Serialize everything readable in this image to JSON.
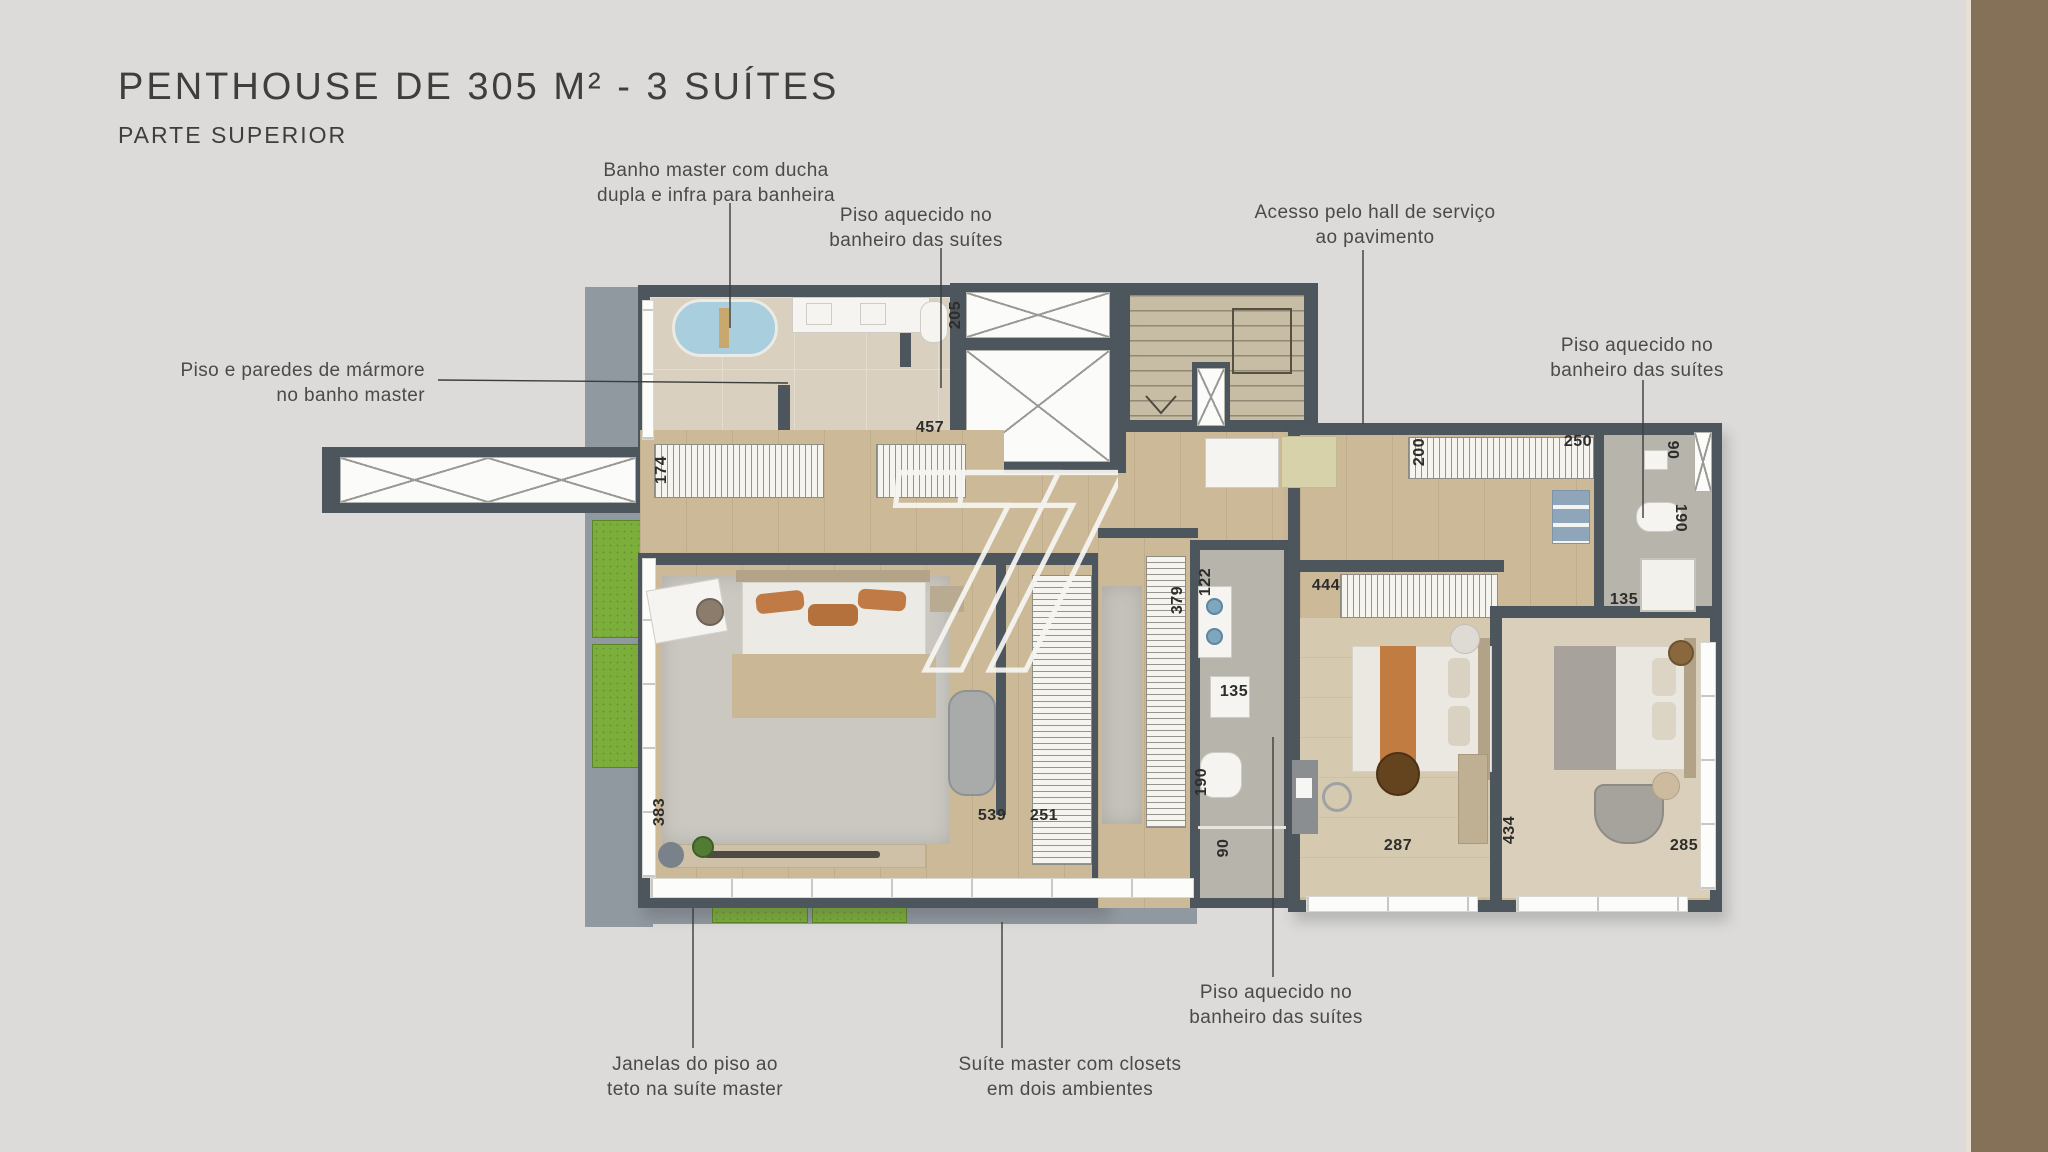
{
  "title": {
    "main": "PENTHOUSE DE 305 M² - 3 SUÍTES",
    "subtitle": "PARTE SUPERIOR"
  },
  "watermark_logo": "7",
  "annotations": [
    {
      "line1": "Banho master com ducha",
      "line2": "dupla e infra para banheira"
    },
    {
      "line1": "Piso aquecido no",
      "line2": "banheiro das suítes"
    },
    {
      "line1": "Acesso pelo hall de serviço",
      "line2": "ao pavimento"
    },
    {
      "line1": "Piso aquecido no",
      "line2": "banheiro das suítes"
    },
    {
      "line1": "Piso e paredes de mármore",
      "line2": "no banho master"
    },
    {
      "line1": "Janelas do piso ao",
      "line2": "teto na suíte master"
    },
    {
      "line1": "Suíte master com closets",
      "line2": "em dois ambientes"
    },
    {
      "line1": "Piso aquecido no",
      "line2": "banheiro das suítes"
    }
  ],
  "dims": [
    {
      "value": "205"
    },
    {
      "value": "457"
    },
    {
      "value": "174"
    },
    {
      "value": "383"
    },
    {
      "value": "539"
    },
    {
      "value": "251"
    },
    {
      "value": "379"
    },
    {
      "value": "122"
    },
    {
      "value": "135"
    },
    {
      "value": "190"
    },
    {
      "value": "90"
    },
    {
      "value": "444"
    },
    {
      "value": "200"
    },
    {
      "value": "250"
    },
    {
      "value": "90"
    },
    {
      "value": "190"
    },
    {
      "value": "135"
    },
    {
      "value": "287"
    },
    {
      "value": "434"
    },
    {
      "value": "285"
    }
  ],
  "colors": {
    "wall": "#4d565c",
    "wood_floor": "#ccb998",
    "bath_floor": "#d9d0c0",
    "tile_floor": "#b7b4ac",
    "deck": "#9098a0",
    "grass": "#7cae3c",
    "tub_blue": "#a9cedd",
    "accent_orange": "#c07c41",
    "background": "#dcdbd9",
    "side_band": "#847158"
  }
}
